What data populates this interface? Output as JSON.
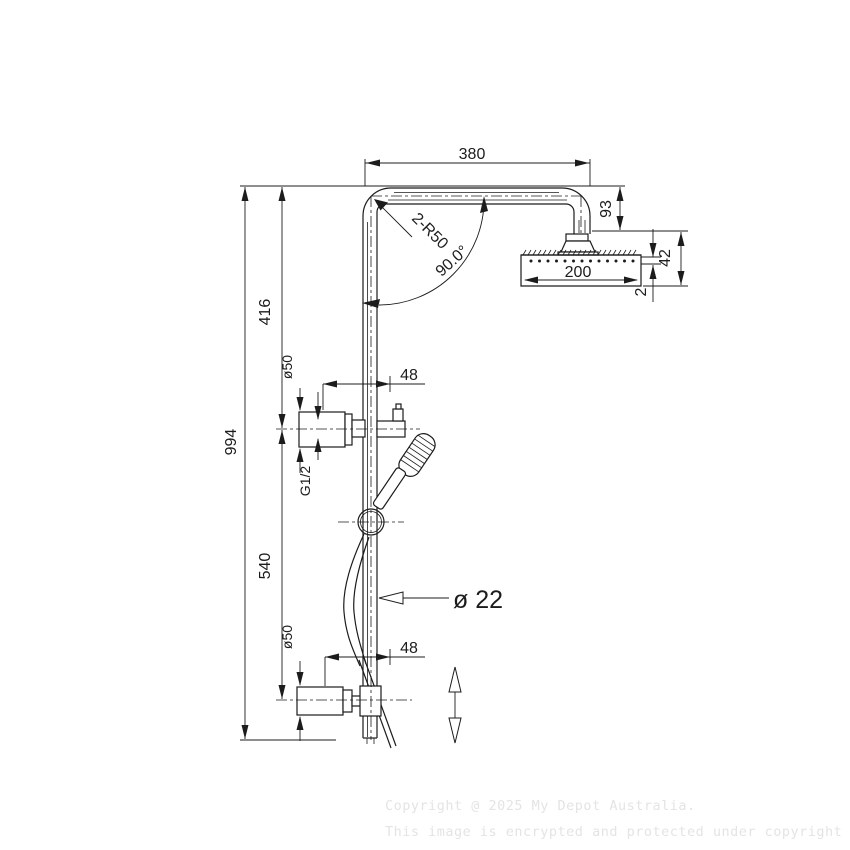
{
  "drawing": {
    "type": "technical-dimension-drawing",
    "product": "twin shower rail with overhead shower and hand shower",
    "dimensions": {
      "arm_length": "380",
      "corner_radius": "2-R50",
      "bend_angle": "90.0°",
      "head_drop": "93",
      "head_diameter": "200",
      "head_assembly_height": "42",
      "faceplate_thickness": "2",
      "upper_section_height": "416",
      "overall_height": "994",
      "lower_section_height": "540",
      "diverter_diameter": "ø50",
      "diverter_offset": "48",
      "thread_size": "G1/2",
      "rail_diameter": "ø 22",
      "valve_diameter": "ø50",
      "valve_offset": "48"
    }
  },
  "watermark": {
    "line1": "Copyright @ 2025 My Depot Australia.",
    "line2": "This image is encrypted and protected under copyright law."
  },
  "colors": {
    "line": "#1c1c1c",
    "watermark": "#e4e4e4",
    "background": "#ffffff"
  }
}
